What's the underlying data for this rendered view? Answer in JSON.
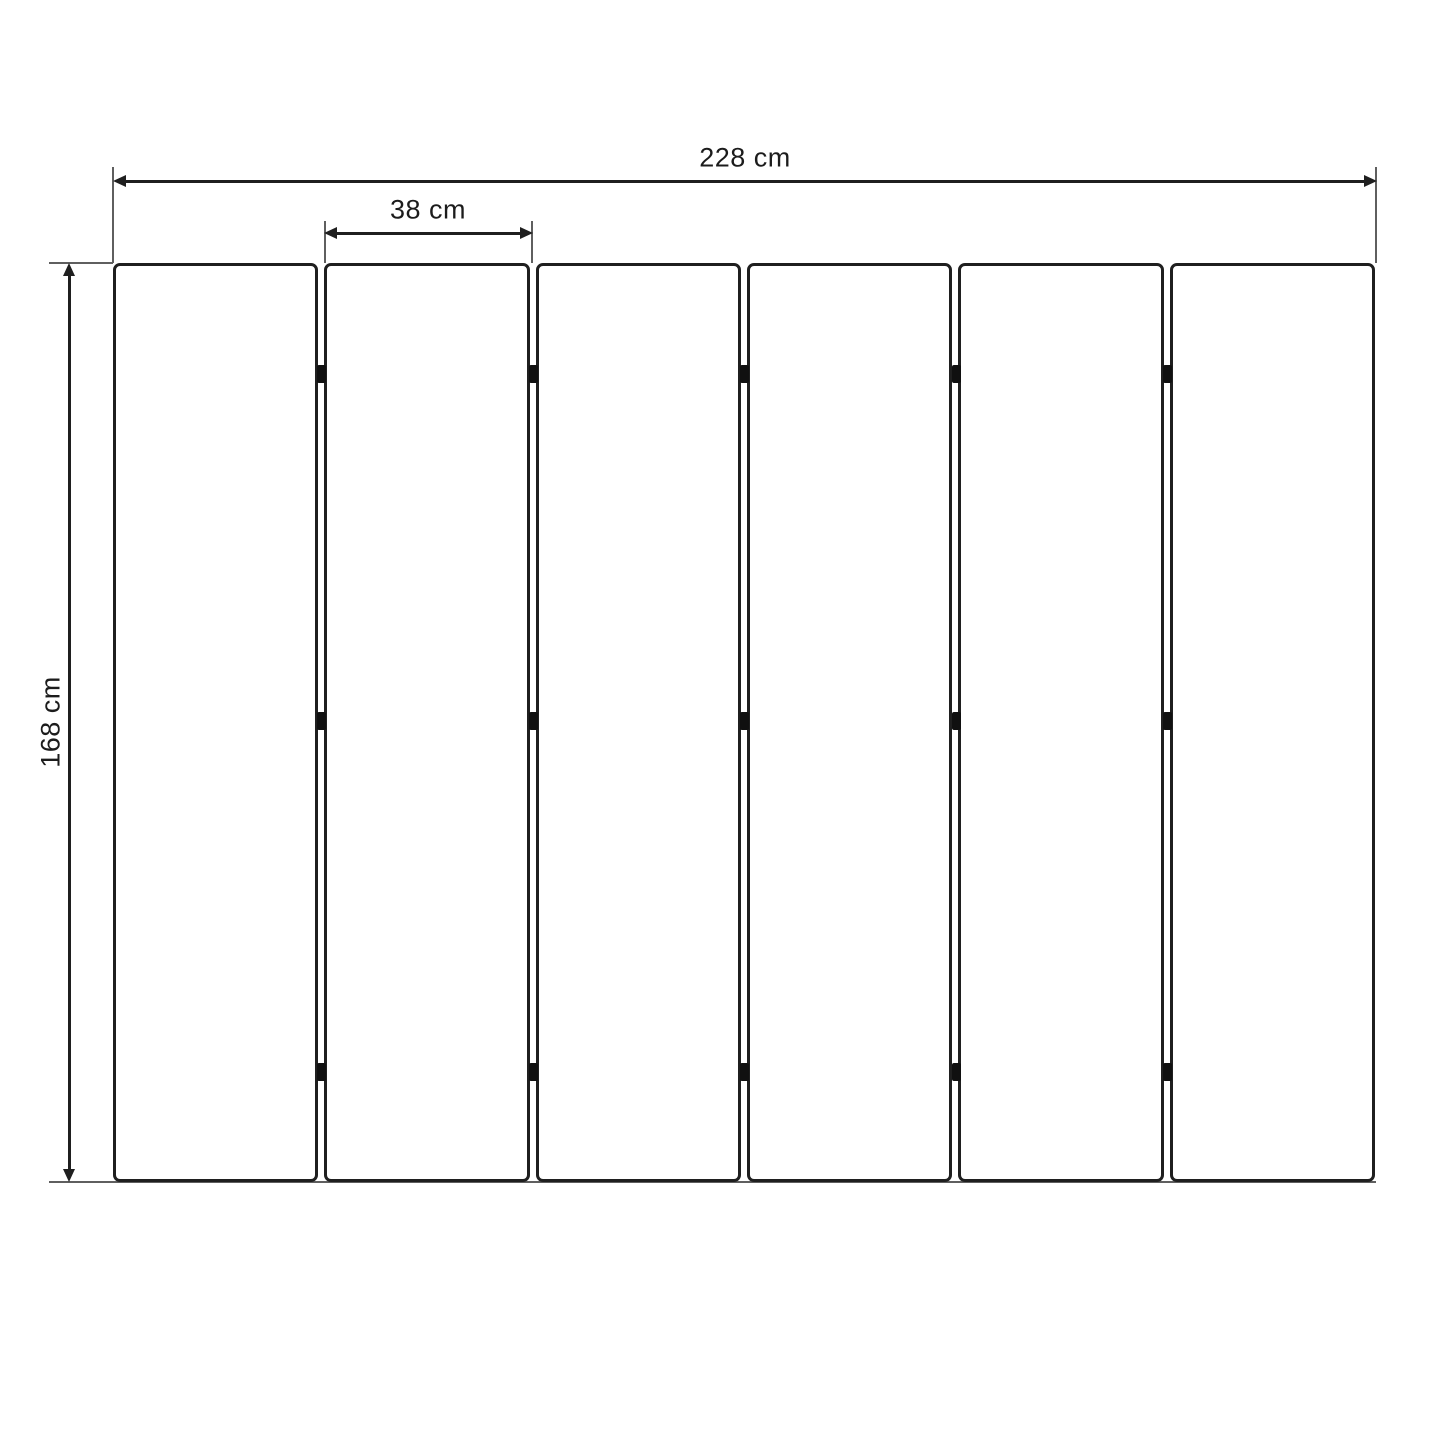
{
  "diagram": {
    "kind": "dimension_drawing",
    "subject": "six-panel folding screen, front elevation",
    "panel_count": 6,
    "hinge_rows_per_gap": 3,
    "dimensions": {
      "total_width": {
        "label": "228 cm",
        "value": 228,
        "unit": "cm"
      },
      "panel_width": {
        "label": "38 cm",
        "value": 38,
        "unit": "cm"
      },
      "height": {
        "label": "168 cm",
        "value": 168,
        "unit": "cm"
      }
    },
    "colors": {
      "background": "#ffffff",
      "panel_fill": "#ffffff",
      "line": "#1f1f1f",
      "extension_line": "#5f5f5f",
      "hinge": "#101010"
    }
  }
}
